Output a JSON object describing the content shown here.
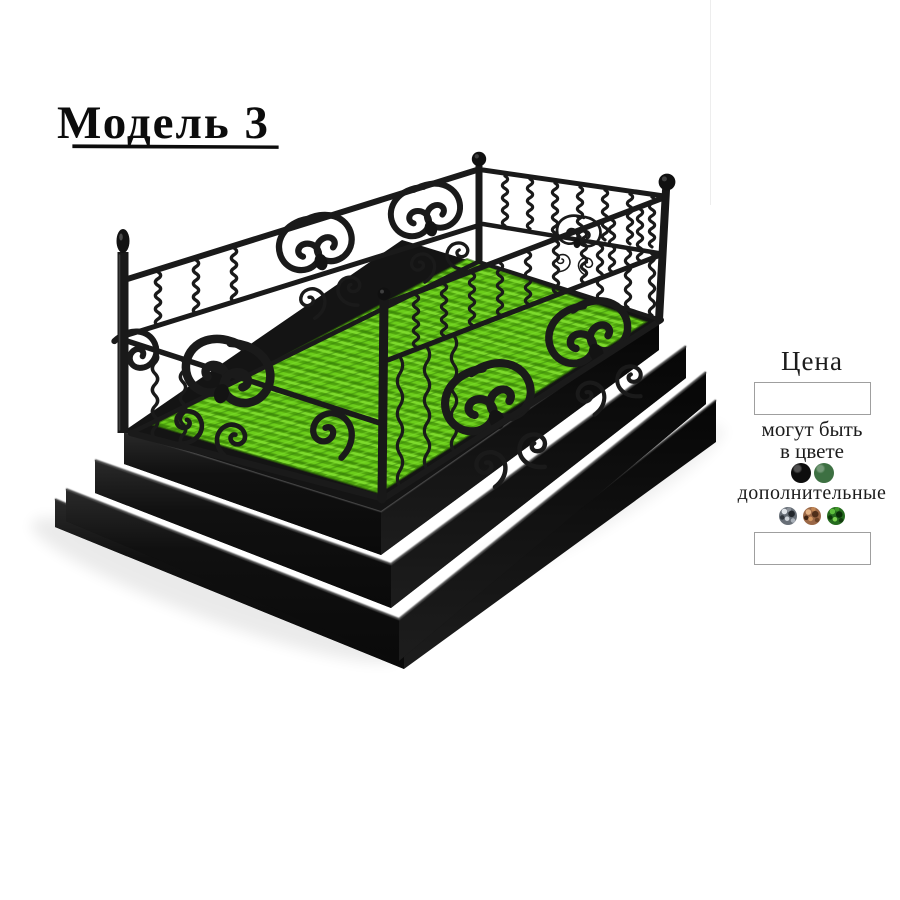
{
  "page": {
    "background_color": "#ffffff"
  },
  "header": {
    "title": "Модель 3"
  },
  "product_image": {
    "label": "wrought-iron-fence-with-lawn-on-stepped-plinth",
    "grass_color": "#58ad10",
    "metal_color": "#161616",
    "plinth_color": "#101010"
  },
  "price_panel": {
    "heading": "Цена",
    "price_value": "",
    "note_line1": "могут быть",
    "note_line2": "в цвете",
    "base_colors": [
      {
        "name": "black",
        "hex": "#0d0d0d"
      },
      {
        "name": "green",
        "hex": "#3d7042"
      }
    ],
    "additional_label": "дополнительные",
    "additional_colors": [
      {
        "name": "silver-speckle",
        "hex": "#686f77"
      },
      {
        "name": "copper-speckle",
        "hex": "#9a6746"
      },
      {
        "name": "green-speckle",
        "hex": "#256b1e"
      }
    ],
    "additional_value": ""
  }
}
